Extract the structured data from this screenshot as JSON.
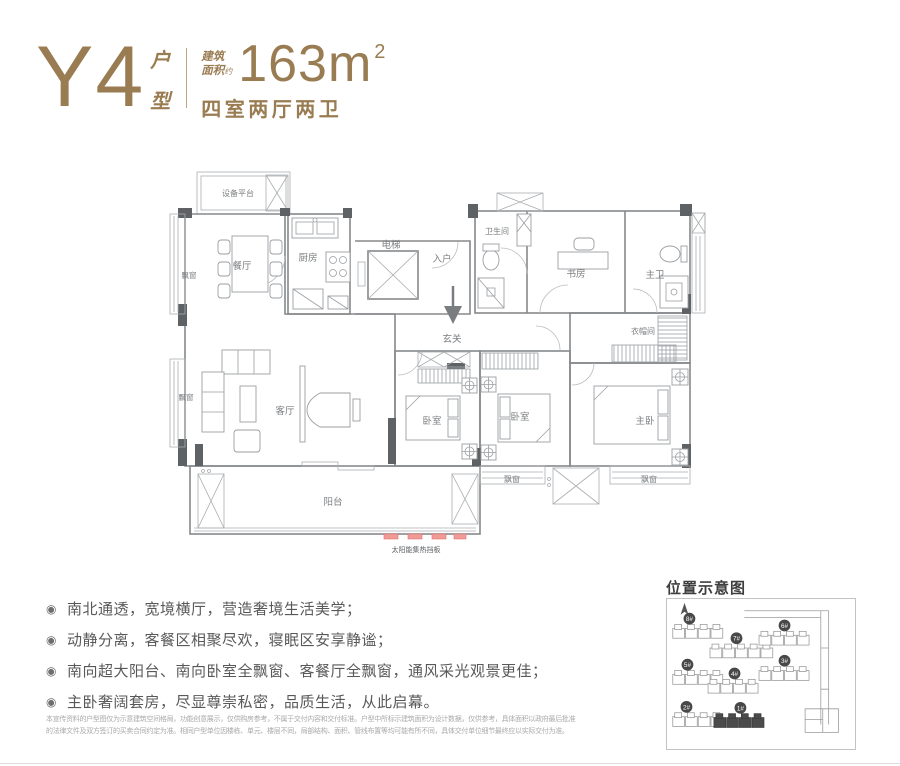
{
  "colors": {
    "accent": "#9A7C52",
    "wall_dark": "#5F6265",
    "solar_red": "#F09B97",
    "badge_dark": "#484848"
  },
  "header": {
    "type_code": "Y4",
    "type_label_chars": [
      "户",
      "型"
    ],
    "area_prefix_line1": "建筑",
    "area_prefix_line2": "面积",
    "area_approx": "约",
    "area_value": "163m",
    "area_unit_sup": "2",
    "layout_text": "四室两厅两卫"
  },
  "floorplan": {
    "rooms": {
      "equipment_platform": "设备平台",
      "dining": "餐厅",
      "kitchen": "厨房",
      "elevator": "电梯",
      "entry": "入户",
      "foyer": "玄关",
      "bathroom": "卫生间",
      "study": "书房",
      "master_bath": "主卫",
      "cloakroom": "衣帽间",
      "living": "客厅",
      "bedroom": "卧室",
      "master_bedroom": "主卧",
      "balcony": "阳台",
      "bay_window": "飘窗"
    },
    "solar_panel_label": "太阳能集热挡板"
  },
  "features": {
    "bullet_glyph": "◉",
    "items": [
      "南北通透，宽境横厅，营造奢境生活美学；",
      "动静分离，客餐区相聚尽欢，寝眠区安享静谧；",
      "南向超大阳台、南向卧室全飘窗、客餐厅全飘窗，通风采光观景更佳；",
      "主卧奢阔套房，尽显尊崇私密，品质生活，从此启幕。"
    ]
  },
  "location_map": {
    "title": "位置示意图",
    "buildings": [
      {
        "label": "8#"
      },
      {
        "label": "7#"
      },
      {
        "label": "6#"
      },
      {
        "label": "5#"
      },
      {
        "label": "4#"
      },
      {
        "label": "3#"
      },
      {
        "label": "2#"
      },
      {
        "label": "1#"
      }
    ],
    "highlighted": "1#"
  },
  "disclaimer": {
    "line1": "本宣传资料的户型图仅为示意建筑空间格局，功能创意展示，仅供购房参考，不属于交付内容和交付标准。户型中所标示建筑面积为设计数据，仅供参考，具体面积以政府最后批准",
    "line2": "的法律文件及双方签订的买卖合同约定为准。相同户型单位因楼栋、单元、楼层不同，局部结构、面积、管线布置等均可能有所不同，具体交付单位细节最终应以实际交付为准。"
  }
}
